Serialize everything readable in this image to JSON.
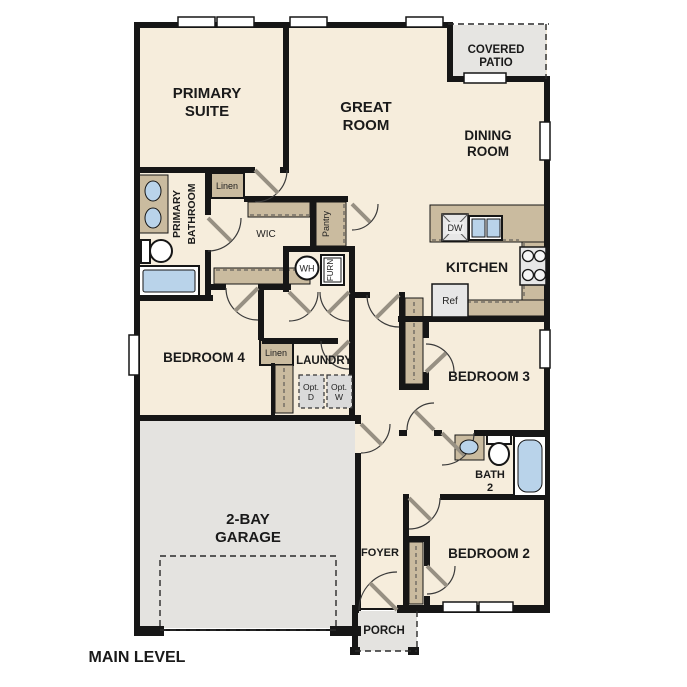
{
  "labels": {
    "primary_suite_1": "PRIMARY",
    "primary_suite_2": "SUITE",
    "great_room_1": "GREAT",
    "great_room_2": "ROOM",
    "covered_patio_1": "COVERED",
    "covered_patio_2": "PATIO",
    "dining_room_1": "DINING",
    "dining_room_2": "ROOM",
    "kitchen": "KITCHEN",
    "primary_bathroom_1": "PRIMARY",
    "primary_bathroom_2": "BATHROOM",
    "wic": "WIC",
    "pantry": "Pantry",
    "linen_bathroom": "Linen",
    "linen_hall": "Linen",
    "water_heater": "WH",
    "furnace": "FURN",
    "dishwasher": "DW",
    "refrigerator": "Ref",
    "laundry": "LAUNDRY",
    "opt_dryer_1": "Opt.",
    "opt_dryer_2": "D",
    "opt_washer_1": "Opt.",
    "opt_washer_2": "W",
    "bedroom_4": "BEDROOM 4",
    "bedroom_3": "BEDROOM 3",
    "bedroom_2": "BEDROOM 2",
    "bath_2_1": "BATH",
    "bath_2_2": "2",
    "garage_1": "2-BAY",
    "garage_2": "GARAGE",
    "foyer": "FOYER",
    "porch": "PORCH",
    "main_level": "MAIN LEVEL"
  },
  "colors": {
    "floor": "#f6eddc",
    "garage_floor": "#e4e3e0",
    "patio_floor": "#e6e5e2",
    "porch_floor": "#e4e3e0",
    "cabinet_tan": "#cabb9f",
    "wall": "#161616",
    "fixture_blue": "#b9d3ea",
    "appliance_gray": "#e7e7e7",
    "label": "#1a1a1a"
  }
}
